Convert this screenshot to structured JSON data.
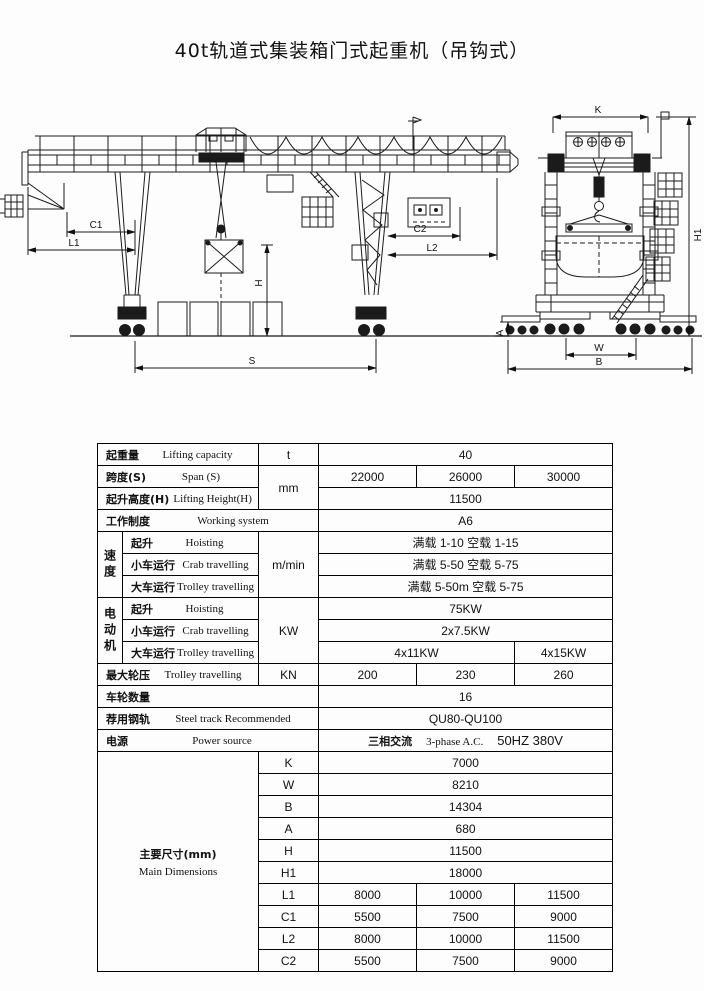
{
  "title": "40t轨道式集装箱门式起重机（吊钩式）",
  "drawing": {
    "labels": {
      "c1": "C1",
      "l1": "L1",
      "c2": "C2",
      "l2": "L2",
      "s": "S",
      "h": "H",
      "k": "K",
      "a": "A",
      "w": "W",
      "b": "B",
      "h1": "H1"
    }
  },
  "table": {
    "lifting_capacity": {
      "zh": "起重量",
      "en": "Lifting capacity",
      "unit": "t",
      "value": "40"
    },
    "span": {
      "zh": "跨度(S)",
      "en": "Span (S)",
      "unit": "mm",
      "values": [
        "22000",
        "26000",
        "30000"
      ]
    },
    "lifting_height": {
      "zh": "起升高度(H)",
      "en": "Lifting Height(H)",
      "value": "11500"
    },
    "working_system": {
      "zh": "工作制度",
      "en": "Working system",
      "value": "A6"
    },
    "speed": {
      "group_zh": "速度",
      "unit": "m/min",
      "rows": [
        {
          "zh": "起升",
          "en": "Hoisting",
          "value": "满载 1-10  空载 1-15"
        },
        {
          "zh": "小车运行",
          "en": "Crab travelling",
          "value": "满载 5-50   空载 5-75"
        },
        {
          "zh": "大车运行",
          "en": "Trolley travelling",
          "value": "满载 5-50m  空载 5-75"
        }
      ]
    },
    "motor": {
      "group_zh": "电动机",
      "unit": "KW",
      "rows": [
        {
          "zh": "起升",
          "en": "Hoisting",
          "value": "75KW"
        },
        {
          "zh": "小车运行",
          "en": "Crab travelling",
          "value": "2x7.5KW"
        },
        {
          "zh": "大车运行",
          "en": "Trolley travelling",
          "value_a": "4x11KW",
          "value_b": "4x15KW"
        }
      ]
    },
    "max_wheel_load": {
      "zh": "最大轮压",
      "en": "Trolley travelling",
      "unit": "KN",
      "values": [
        "200",
        "230",
        "260"
      ]
    },
    "wheel_count": {
      "zh": "车轮数量",
      "value": "16"
    },
    "steel_track": {
      "zh": "荐用钢轨",
      "en": "Steel track Recommended",
      "value": "QU80-QU100"
    },
    "power": {
      "zh": "电源",
      "en": "Power source",
      "value_zh": "三相交流",
      "value_en": "3-phase  A.C.",
      "value_hz": "50HZ 380V"
    },
    "main_dimensions": {
      "zh": "主要尺寸(mm)",
      "en": "Main Dimensions",
      "single_rows": [
        {
          "key": "K",
          "value": "7000"
        },
        {
          "key": "W",
          "value": "8210"
        },
        {
          "key": "B",
          "value": "14304"
        },
        {
          "key": "A",
          "value": "680"
        },
        {
          "key": "H",
          "value": "11500"
        },
        {
          "key": "H1",
          "value": "18000"
        }
      ],
      "multi_rows": [
        {
          "key": "L1",
          "values": [
            "8000",
            "10000",
            "11500"
          ]
        },
        {
          "key": "C1",
          "values": [
            "5500",
            "7500",
            "9000"
          ]
        },
        {
          "key": "L2",
          "values": [
            "8000",
            "10000",
            "11500"
          ]
        },
        {
          "key": "C2",
          "values": [
            "5500",
            "7500",
            "9000"
          ]
        }
      ]
    }
  }
}
